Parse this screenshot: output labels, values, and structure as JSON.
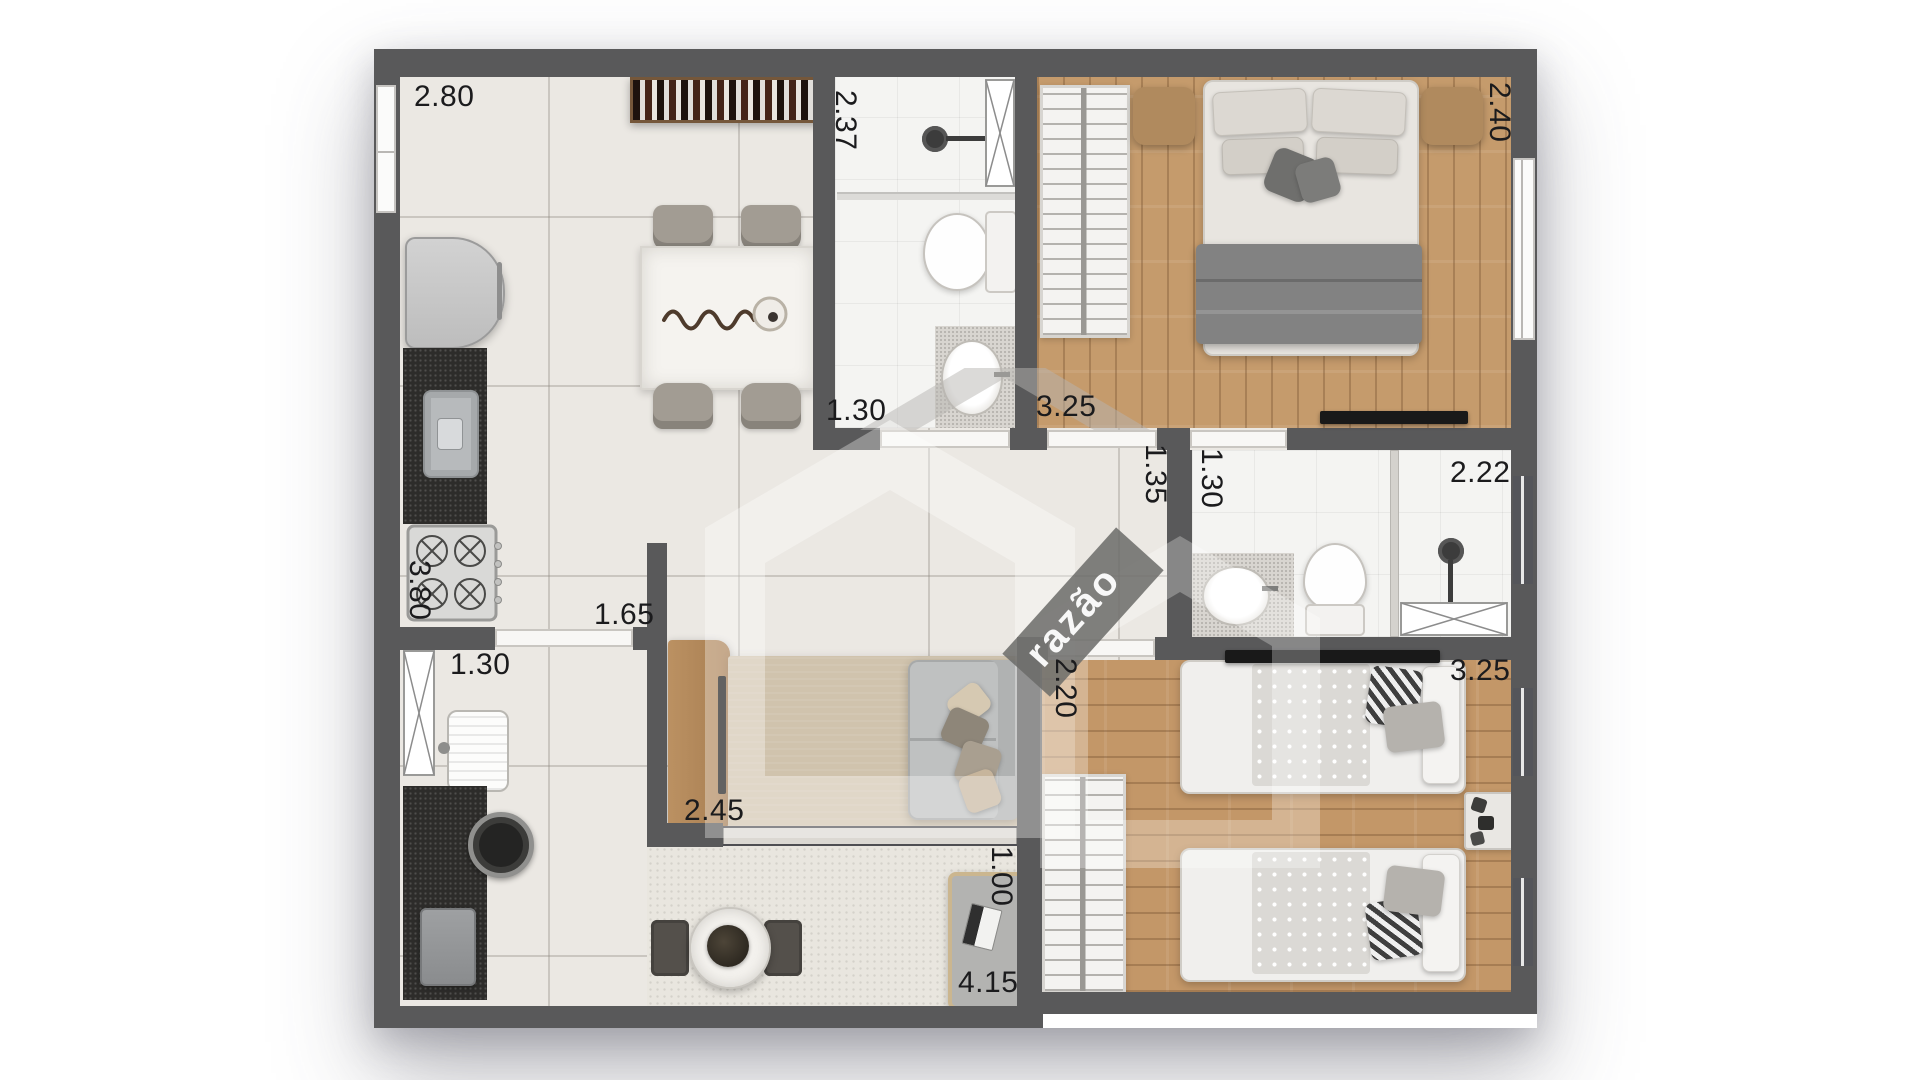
{
  "watermark": {
    "text": "razão"
  },
  "colors": {
    "wall": "#59595a",
    "tile_floor": "#ebe8e3",
    "wood_floor": "#c59b6c",
    "bath_floor": "#f4f4f2",
    "counter_granite": "#2d2c2a",
    "rug": "#d0c3ad",
    "label_text": "#1b1b1d"
  },
  "dims": {
    "kitchen_width": "2.80",
    "bath1_depth": "2.37",
    "bedroom1_depth": "2.40",
    "bath1_door": "1.30",
    "bedroom1_door": "3.25",
    "hall_width": "1.35",
    "bath2_door": "1.30",
    "bath2_width": "2.22",
    "kitchen_depth": "3.80",
    "kitchen_pass": "1.65",
    "service_width": "1.30",
    "tv_wall": "2.45",
    "bedroom2_side": "2.20",
    "bedroom2_width": "3.25",
    "balcony_depth": "1.00",
    "balcony_width": "4.15"
  }
}
